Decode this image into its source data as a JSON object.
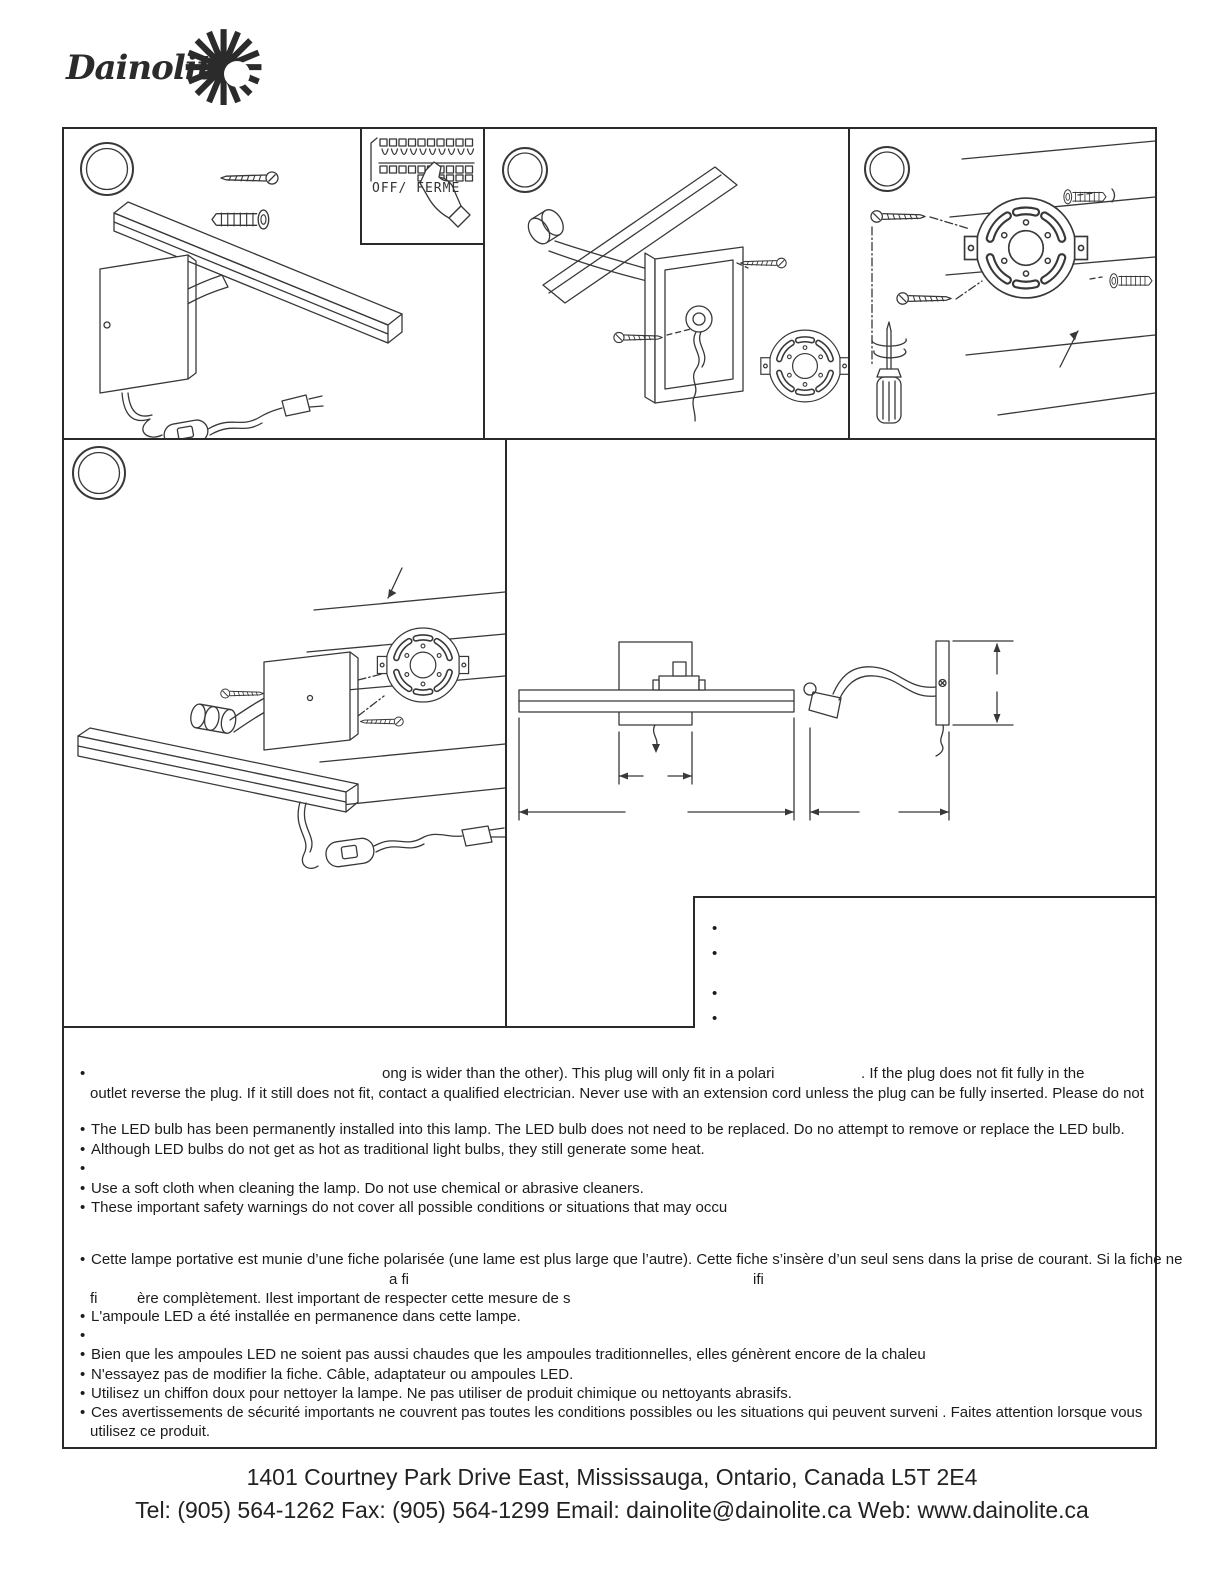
{
  "logo": {
    "brand": "Dainolite",
    "star_glyph": "✺",
    "icon": "starburst"
  },
  "panels": {
    "inset_label": "OFF/ FERME"
  },
  "ui": {
    "bullet": "•"
  },
  "warnings_en": {
    "plug_line1_frag1": "ong is wider than the other). This plug will only fit in a polari",
    "plug_line1_frag2": ". If the plug does not fit fully in the",
    "plug_line2": "outlet reverse the plug. If it still does not fit, contact a qualified electrician. Never use with an extension cord unless the plug can be fully inserted. Please do not",
    "led_installed": "The LED bulb has been permanently installed into this lamp. The LED bulb does not need to be replaced. Do no attempt to remove or replace the LED bulb.",
    "led_heat": "Although LED bulbs do not get as hot as traditional light bulbs, they still generate some heat.",
    "soft_cloth": "Use a soft cloth when cleaning the lamp. Do not use chemical or abrasive cleaners.",
    "safety_warnings": "These important safety warnings do not cover all possible conditions or situations that may occu"
  },
  "warnings_fr": {
    "fiche_line1": "Cette lampe portative est munie d’une fiche polarisée (une lame est plus large que l’autre). Cette fiche s’insère d’un seul sens dans la prise de courant. Si la fiche ne",
    "fiche_line2_frag1": "a fi",
    "fiche_line2_frag2": "ifi",
    "fiche_line3_frag1": "fi",
    "fiche_line3_frag2": "ère complètement. Ilest important de respecter cette mesure de s",
    "ampoule": "L'ampoule LED a été installée en permanence dans cette lampe.",
    "chaleur": "Bien que les ampoules LED ne soient pas aussi chaudes que les ampoules traditionnelles, elles génèrent encore de la chaleu",
    "modifier": "N'essayez pas de modifier la fiche. Câble, adaptateur ou ampoules LED.",
    "chiffon": "Utilisez un chiffon doux pour nettoyer la lampe. Ne pas utiliser de produit chimique ou nettoyants abrasifs.",
    "avertissements_line1": "Ces avertissements de sécurité importants ne couvrent pas toutes les conditions possibles ou les situations qui peuvent surveni . Faites attention lorsque vous",
    "avertissements_line2": "utilisez ce produit."
  },
  "footer": {
    "address": "1401 Courtney Park Drive East, Mississauga, Ontario, Canada L5T 2E4",
    "contact": "Tel: (905) 564-1262 Fax: (905) 564-1299 Email: dainolite@dainolite.ca Web: www.dainolite.ca"
  },
  "colors": {
    "ink": "#1c1c1c",
    "line": "#2a2a2a",
    "background": "#ffffff"
  }
}
